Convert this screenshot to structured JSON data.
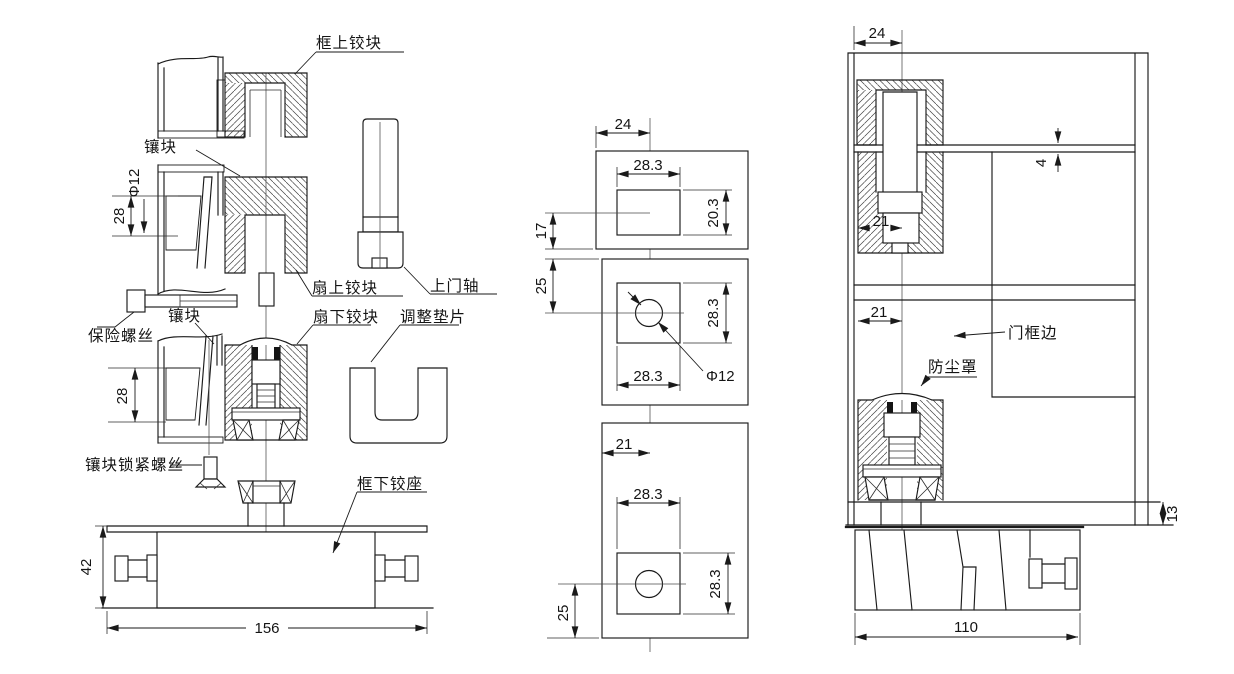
{
  "page": {
    "background": "#ffffff",
    "line_color": "#1a1a1a",
    "kind": "pivot hinge assembly technical drawing"
  },
  "left_view": {
    "name": "exploded assembly elevation",
    "labels": {
      "frame_top_hinge_block": "框上铰块",
      "insert_block_upper": "镶块",
      "leaf_top_hinge_block": "扇上铰块",
      "top_door_axle": "上门轴",
      "safety_screw": "保险螺丝",
      "insert_block_lower": "镶块",
      "leaf_bottom_hinge_block": "扇下铰块",
      "adjustment_shim": "调整垫片",
      "insert_lock_screw": "镶块锁紧螺丝",
      "frame_bottom_hinge_seat": "框下铰座"
    },
    "dims": {
      "pivot_hole_dia": "Φ12",
      "insert_height_upper": "28",
      "insert_height_lower": "28",
      "seat_height": "42",
      "seat_width": "156"
    }
  },
  "middle_view": {
    "name": "mounting plate plan views",
    "top_block": {
      "edge_to_center": "24",
      "cutout_width": "28.3",
      "cutout_height": "20.3",
      "center_to_edge": "17"
    },
    "mid_block": {
      "edge_to_center": "25",
      "cutout_width": "28.3",
      "cutout_height": "28.3",
      "hole_dia": "Φ12"
    },
    "bottom_block": {
      "edge_to_center": "21",
      "cutout_width": "28.3",
      "cutout_height": "28.3",
      "center_to_edge": "25"
    }
  },
  "right_view": {
    "name": "installed section view",
    "labels": {
      "door_frame_edge": "门框边",
      "dust_cover": "防尘罩"
    },
    "dims": {
      "pivot_to_edge_top": "24",
      "top_clearance": "4",
      "pivot_inset_upper": "21",
      "pivot_inset_lower": "21",
      "floor_clearance": "13",
      "floor_box_width": "110"
    }
  }
}
